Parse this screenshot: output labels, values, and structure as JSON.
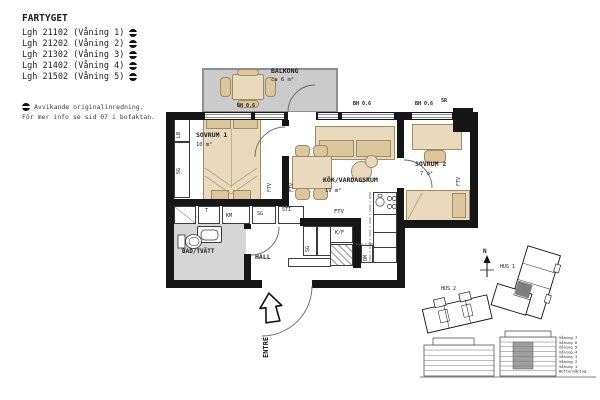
{
  "header": {
    "title": "FARTYGET",
    "apartments": [
      "Lgh 21102 (Våning 1)",
      "Lgh 21202 (Våning 2)",
      "Lgh 21302 (Våning 3)",
      "Lgh 21402 (Våning 4)",
      "Lgh 21502 (Våning 5)"
    ],
    "note_line1": "Avvikande originalinredning.",
    "note_line2": "För mer info se sid 07 i bofaktan."
  },
  "plan": {
    "balcony": {
      "name": "BALKONG",
      "area": "ca 6 m²",
      "rail_label": "BH 0.6"
    },
    "bedroom1": {
      "name": "SOVRUM 1",
      "area": "10 m²"
    },
    "living": {
      "name": "KÖK/VARDAGSRUM",
      "area": "19 m²"
    },
    "bedroom2": {
      "name": "SOVRUM 2",
      "area": "7 m²"
    },
    "bath": {
      "name": "BAD/TVÄTT"
    },
    "hall": {
      "name": "HALL"
    },
    "entry": {
      "name": "ENTRÉ"
    },
    "windows": {
      "bh1": "BH 0.6",
      "bh2": "BH 0.6",
      "sr": "SR"
    },
    "fixtures": {
      "lb": "LB",
      "sg1": "SG",
      "t": "T",
      "km": "KM",
      "sg2": "SG",
      "sti": "STI",
      "ftv1": "FTV",
      "ftv2": "FTV",
      "ftv3": "FTV",
      "ftv4": "FTV",
      "kf": "K/F",
      "sg3": "SG",
      "dm": "DM"
    }
  },
  "site": {
    "north": "N",
    "hus1": "HUS 1",
    "hus2": "HUS 2"
  },
  "elevation": {
    "floors": [
      "Våning 7",
      "Våning 6",
      "Våning 5",
      "Våning 4",
      "Våning 3",
      "Våning 2",
      "Våning 1",
      "Bottenvåning"
    ]
  },
  "colors": {
    "wall": "#161616",
    "furniture": "#e9dabd",
    "balcony_floor": "#cbcbcb",
    "bath_floor": "#d6d6d6",
    "highlight_unit": "#7e7e7e"
  }
}
